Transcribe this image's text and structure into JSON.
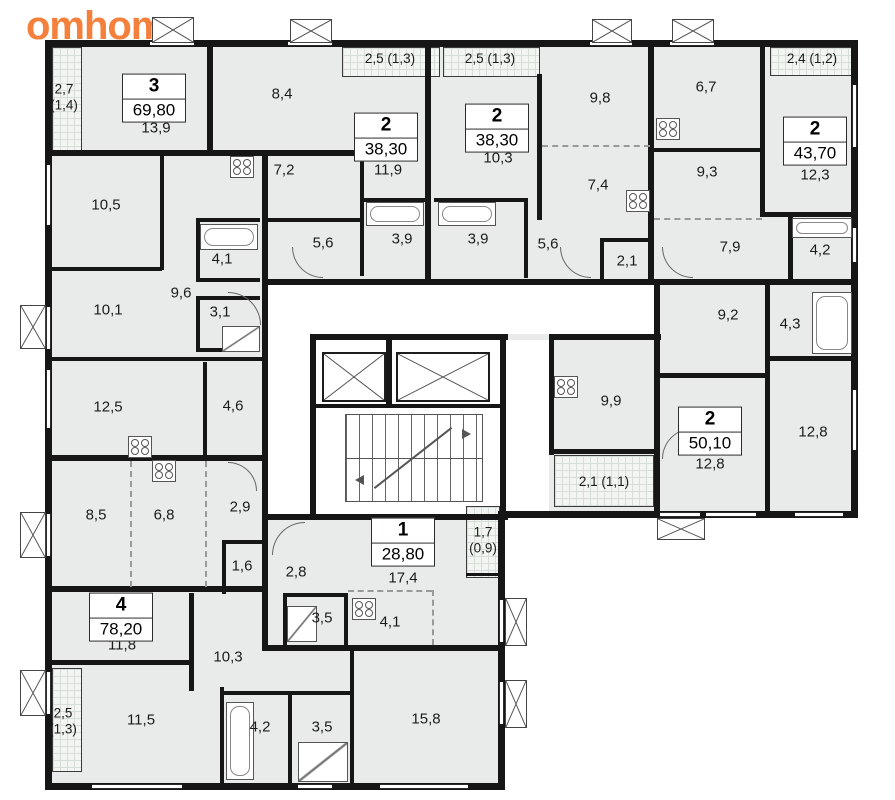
{
  "logo": {
    "text": "omhome"
  },
  "colors": {
    "logo_orange": "#f5803c",
    "wall_black": "#161616",
    "room_gray": "#e9ebea",
    "hatch_gray": "#f3f5f3"
  },
  "apartments": [
    {
      "rooms": "3",
      "area": "69,80"
    },
    {
      "rooms": "2",
      "area": "38,30"
    },
    {
      "rooms": "2",
      "area": "38,30"
    },
    {
      "rooms": "2",
      "area": "43,70"
    },
    {
      "rooms": "2",
      "area": "50,10"
    },
    {
      "rooms": "1",
      "area": "28,80"
    },
    {
      "rooms": "4",
      "area": "78,20"
    }
  ],
  "room_labels": {
    "l01": "2,7\n(1,4)",
    "l02": "13,9",
    "l03": "8,4",
    "l04": "2,5 (1,3)",
    "l05": "2,5 (1,3)",
    "l06": "9,8",
    "l07": "6,7",
    "l08": "2,4 (1,2)",
    "l09": "11,9",
    "l10": "10,3",
    "l11": "12,3",
    "l12": "10,5",
    "l13": "7,2",
    "l14": "7,4",
    "l15": "9,3",
    "l16": "5,6",
    "l17": "3,9",
    "l18": "3,9",
    "l19": "5,6",
    "l20": "2,1",
    "l21": "7,9",
    "l22": "4,2",
    "l23": "4,1",
    "l24": "9,6",
    "l25": "10,1",
    "l26": "3,1",
    "l27": "9,2",
    "l28": "4,3",
    "l29": "12,5",
    "l30": "4,6",
    "l31": "9,9",
    "l32": "12,8",
    "l33": "12,8",
    "l34": "2,1 (1,1)",
    "l35": "8,5",
    "l36": "6,8",
    "l37": "2,9",
    "l38": "1,7\n(0,9)",
    "l39": "17,4",
    "l40": "1,6",
    "l41": "2,8",
    "l42": "3,5",
    "l43": "4,1",
    "l44": "11,8",
    "l45": "10,3",
    "l46": "2,5\n(1,3)",
    "l47": "11,5",
    "l48": "4,2",
    "l49": "3,5",
    "l50": "15,8"
  }
}
